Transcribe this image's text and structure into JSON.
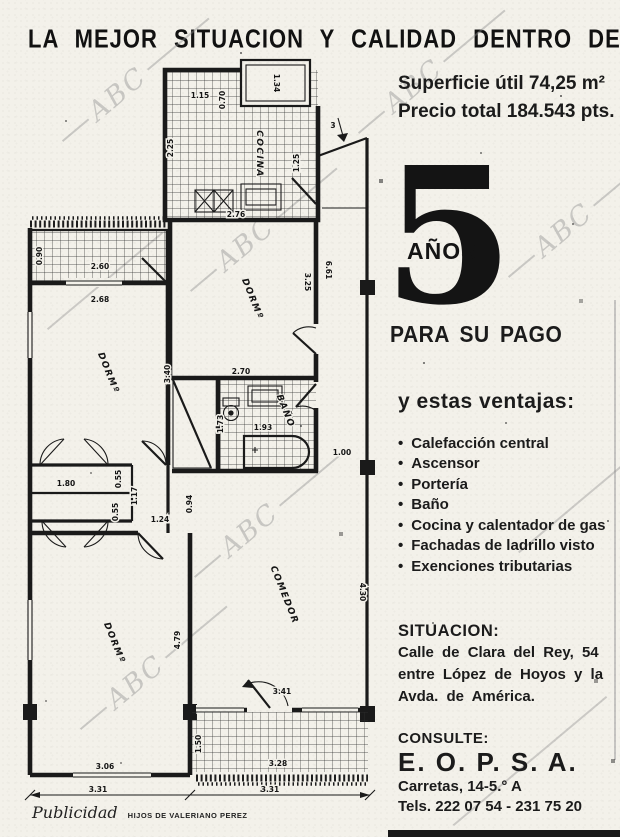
{
  "headline": "LA MEJOR SITUACION Y CALIDAD DENTRO DE SU PRECIO",
  "offer": {
    "superficie": "Superficie útil 74,25 m²",
    "precio": "Precio total 184.543 pts.",
    "years_digit": "5",
    "years_word": "AÑOS",
    "payment": "PARA SU PAGO",
    "ventajas_title": "y estas ventajas:",
    "ventajas": [
      "Calefacción central",
      "Ascensor",
      "Portería",
      "Baño",
      "Cocina y calentador de gas",
      "Fachadas de ladrillo visto",
      "Exenciones tributarias"
    ]
  },
  "situacion": {
    "title": "SITUACION:",
    "lines": [
      "Calle de Clara del Rey, 54",
      "entre López de Hoyos y la",
      "Avda. de América."
    ]
  },
  "consulte": {
    "title": "CONSULTE:",
    "company": "E. O. P. S. A.",
    "address": "Carretas, 14-5.° A",
    "phones": "Tels. 222 07 54 - 231 75 20"
  },
  "footer": {
    "script": "Publicidad",
    "agency": "HIJOS DE VALERIANO PEREZ"
  },
  "watermark": "ABC",
  "plan": {
    "rooms": {
      "cocina": "COCINA",
      "dorm_top": "DORMº",
      "dorm_left": "DORMº",
      "dorm_bottom": "DORMº",
      "bano": "BAÑO",
      "comedor": "COMEDOR"
    },
    "dims": {
      "k_top": "1.15",
      "k_patio": "1.34",
      "k_patio_side": "0.70",
      "k_left": "2.25",
      "k_right": "1.25",
      "d1_top": "2.76",
      "d1_right": "3.25",
      "corr_len": "6.61",
      "entry": "3",
      "d1_bot": "2.70",
      "b_left": "1.73",
      "b_w": "1.93",
      "corr_w": "1.00",
      "t1_d": "0.90",
      "t1_w": "2.60",
      "d2_top": "2.68",
      "d2_right": "3.40",
      "c1": "1.80",
      "c1_d": "0.55",
      "hall1": "1.17",
      "c2_d": "0.55",
      "hall2": "1.24",
      "pass": "0.94",
      "d3_right": "4.79",
      "d3_bot": "3.06",
      "total_l": "3.31",
      "total_r": "3.31",
      "com_door": "3.41",
      "com_right": "4.30",
      "t2_d": "1.50",
      "t2_w": "3.28"
    }
  }
}
